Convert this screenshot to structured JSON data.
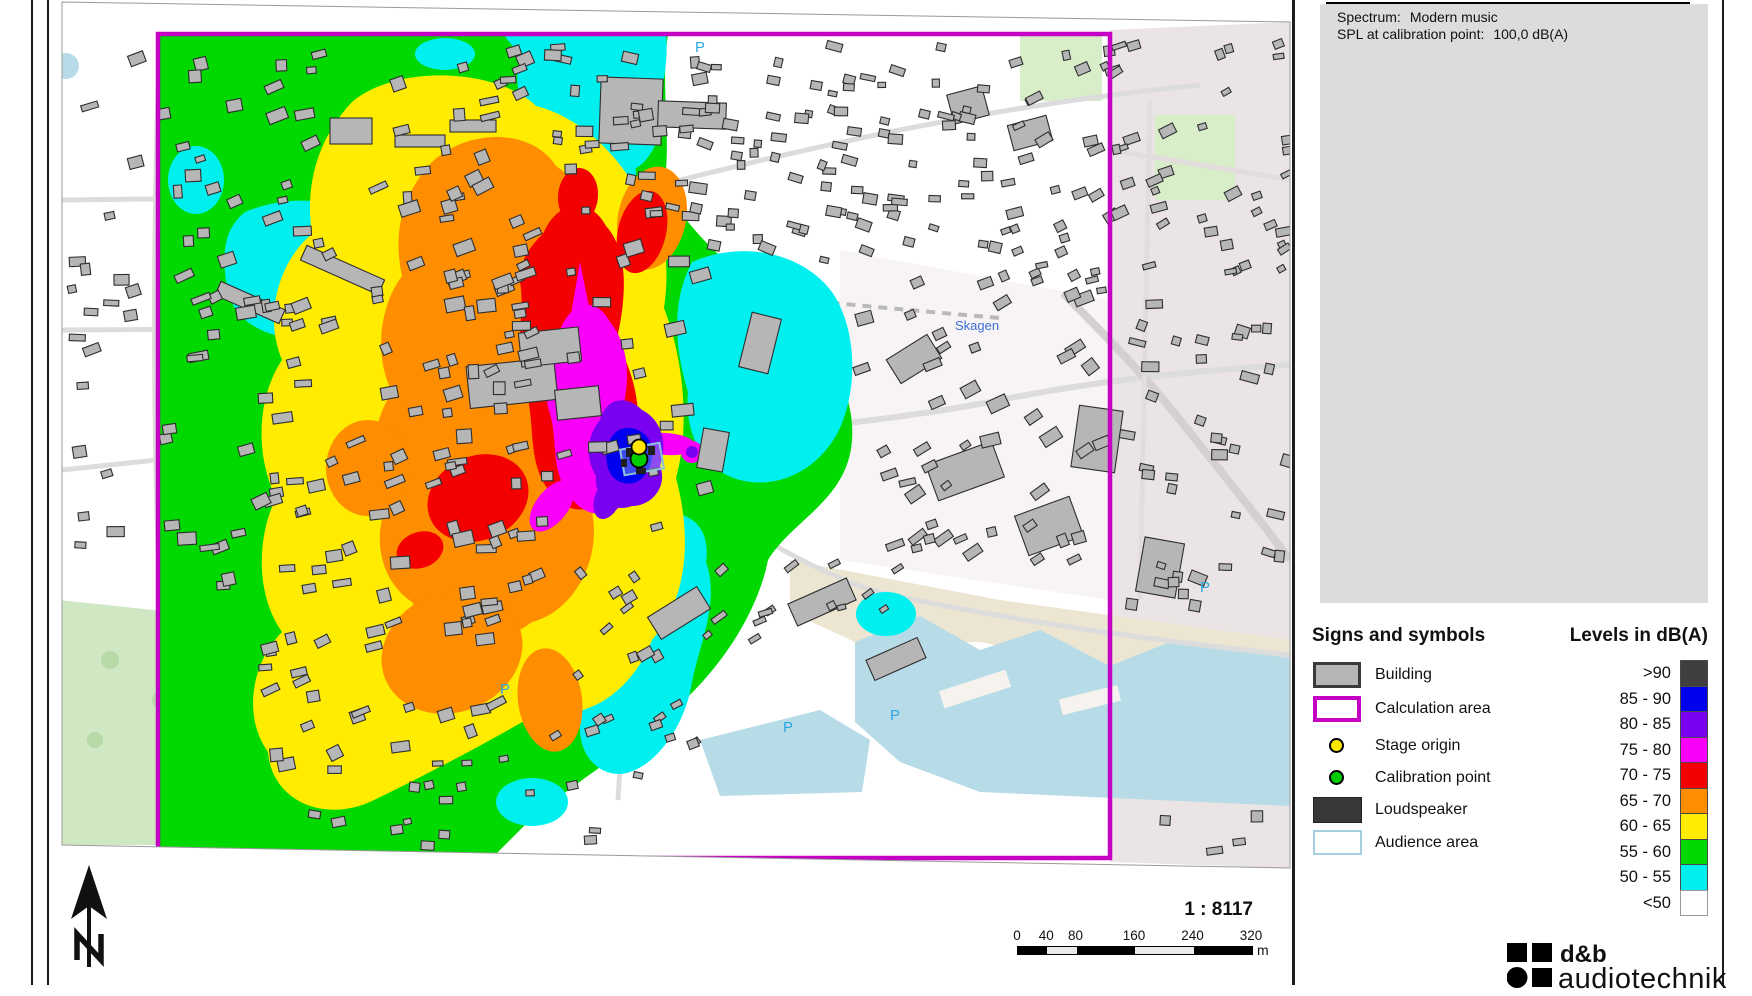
{
  "info_box": {
    "line1_label": "Spectrum:",
    "line1_value": "Modern music",
    "line2_label": "SPL at calibration point:",
    "line2_value": "100,0 dB(A)"
  },
  "signs_legend": {
    "title": "Signs and symbols",
    "items": [
      {
        "label": "Building"
      },
      {
        "label": "Calculation area"
      },
      {
        "label": "Stage origin"
      },
      {
        "label": "Calibration point"
      },
      {
        "label": "Loudspeaker"
      },
      {
        "label": "Audience area"
      }
    ]
  },
  "levels_legend": {
    "title": "Levels in dB(A)",
    "entries": [
      {
        "label": ">90",
        "color": "#3f3f3f"
      },
      {
        "label": "85 - 90",
        "color": "#0000f0"
      },
      {
        "label": "80 - 85",
        "color": "#7a00f0"
      },
      {
        "label": "75 - 80",
        "color": "#fa00fa"
      },
      {
        "label": "70 - 75",
        "color": "#f40000"
      },
      {
        "label": "65 - 70",
        "color": "#ff8d00"
      },
      {
        "label": "60 - 65",
        "color": "#ffec00"
      },
      {
        "label": "55 - 60",
        "color": "#00d900"
      },
      {
        "label": "50 - 55",
        "color": "#00f0f0"
      },
      {
        "label": "<50",
        "color": "#ffffff"
      }
    ]
  },
  "scale_bar": {
    "ratio": "1 : 8117",
    "unit": "m",
    "ticks": [
      "0",
      "40",
      "80",
      "160",
      "240",
      "320"
    ],
    "tick_values": [
      0,
      40,
      80,
      160,
      240,
      320
    ],
    "total_m": 320
  },
  "map": {
    "north_label": "N",
    "parking_label": "P",
    "station_label": "Skagen"
  },
  "branding": {
    "line1": "d&b",
    "line2": "audiotechnik"
  }
}
